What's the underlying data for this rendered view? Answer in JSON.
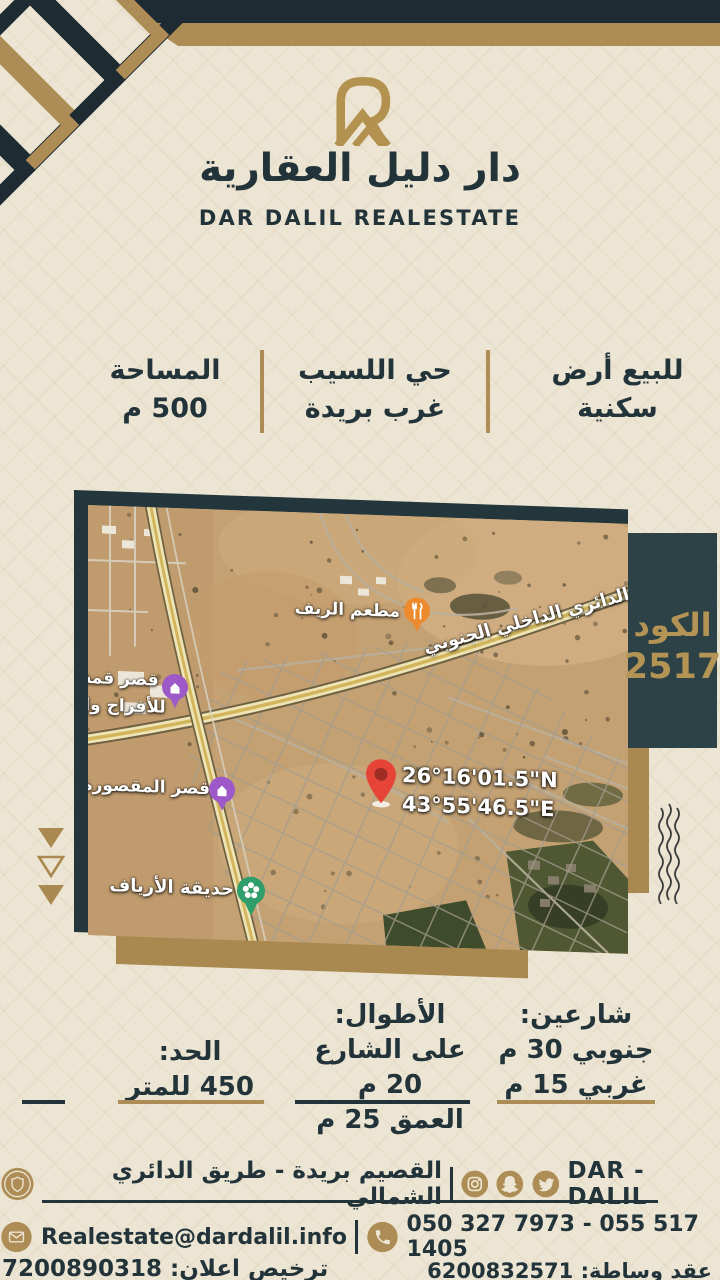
{
  "brand": {
    "logo_arabic": "دار دليل العقارية",
    "logo_english": "DAR DALIL REALESTATE"
  },
  "summary": {
    "columns": [
      {
        "id": "offer",
        "line1": "للبيع أرض",
        "line2": "سكنية"
      },
      {
        "id": "district",
        "line1": "حي اللسيب",
        "line2": "غرب بريدة"
      },
      {
        "id": "area",
        "line1": "المساحة",
        "line2": "500 م"
      }
    ]
  },
  "map": {
    "coordinates_line1": "26°16'01.5\"N",
    "coordinates_line2": "43°55'46.5\"E",
    "labels": {
      "ring_road": "الدائري الداخلي الجنوبي",
      "restaurant": "مطعم الريف",
      "palace1_line1": "قصر قمة",
      "palace1_line2": "للأفراح وا",
      "palace2": "قصر المقصورة",
      "park": "حديقة الأرياف"
    },
    "marker_icons": [
      "red-location-pin",
      "restaurant-marker-icon",
      "palace-marker-icon",
      "park-marker-icon"
    ]
  },
  "code_panel": {
    "label": "الكود",
    "value": "2517"
  },
  "details": {
    "streets": {
      "title": "شارعين:",
      "lines": [
        "جنوبي 30 م",
        "غربي 15 م"
      ]
    },
    "lengths": {
      "title": "الأطوال:",
      "lines": [
        "على الشارع 20 م",
        "العمق 25 م"
      ]
    },
    "price": {
      "title": "الحد:",
      "lines": [
        "450 للمتر"
      ]
    }
  },
  "footer": {
    "brand_name": "DAR - DALIL",
    "address": "القصيم بريدة - طريق الدائري الشمالي",
    "email": "Realestate@dardalil.info",
    "phones": "050 327 7973 - 055 517 1405",
    "license_ad": "ترخيص اعلان: 7200890318",
    "license_contract": "عقد وساطة: 6200832571",
    "social_icons": [
      "badge-logo-icon",
      "instagram-icon",
      "snapchat-icon",
      "twitter-icon"
    ],
    "contact_icons": [
      "envelope-icon",
      "phone-icon"
    ]
  },
  "colors": {
    "cream": "#ece5d3",
    "navy": "#1f2b33",
    "gold": "#ad8d55",
    "panel": "#2d4247",
    "map_shadow": "#23363c",
    "pin_red": "#e64437"
  }
}
